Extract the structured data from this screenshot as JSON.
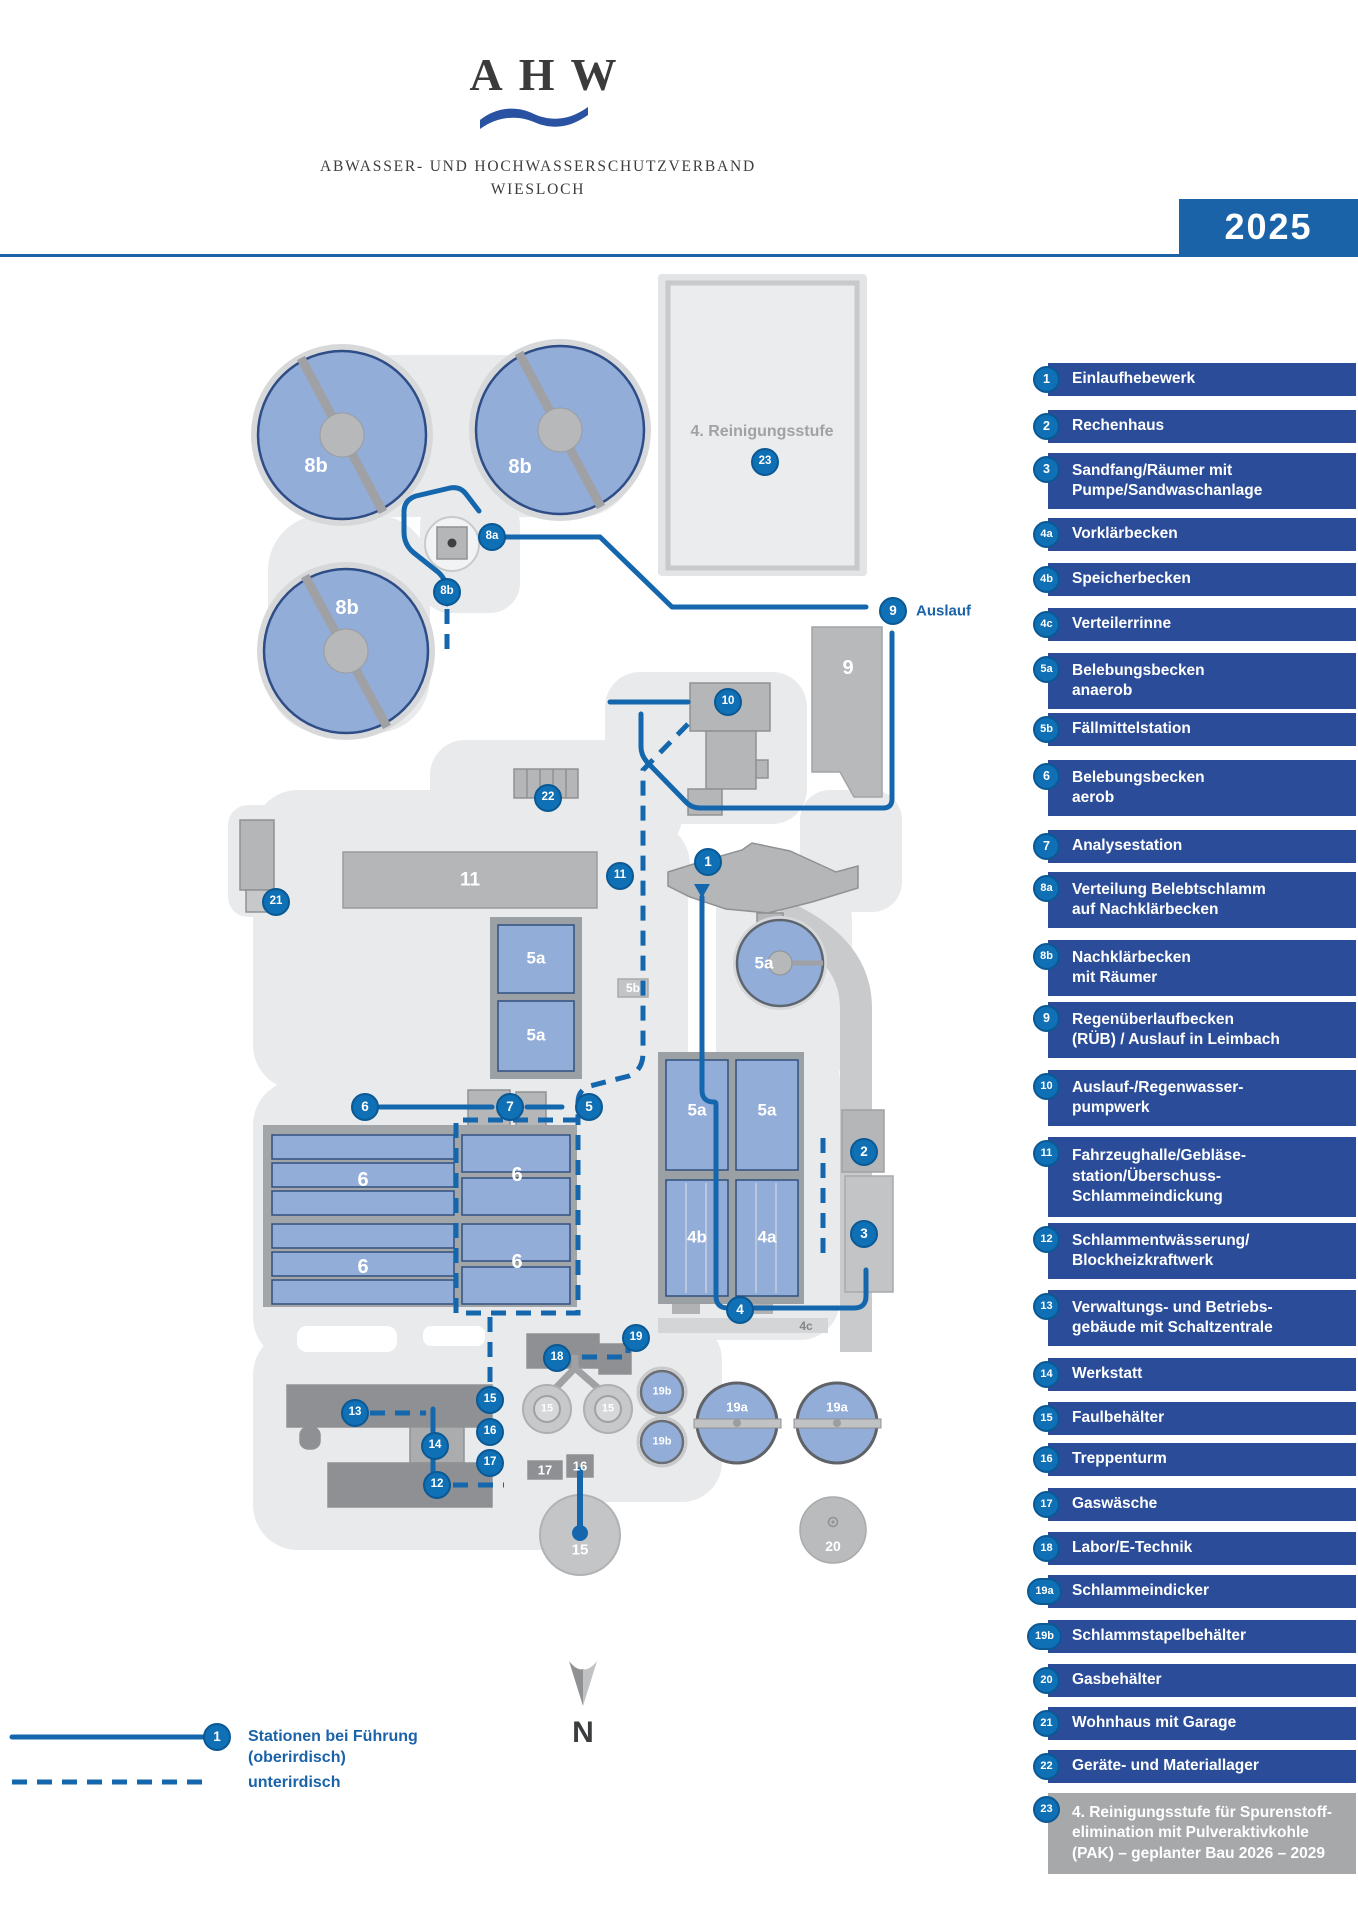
{
  "header": {
    "logo_acronym": "AHW",
    "org_line1": "ABWASSER- UND HOCHWASSERSCHUTZVERBAND",
    "org_line2": "WIESLOCH",
    "year": "2025"
  },
  "colors": {
    "accent_blue": "#1a63a9",
    "pipe_blue": "#1467ad",
    "legend_bar_blue": "#2b4d99",
    "marker_blue": "#0f70b5",
    "basin_blue": "#93add9",
    "ground_gray": "#e9eaeb",
    "building_gray": "#b4b6b8",
    "dark_building_gray": "#8e9093",
    "planned_gray": "#a6a8aa"
  },
  "legend": {
    "items": [
      {
        "num": "1",
        "label": "Einlaufhebewerk"
      },
      {
        "num": "2",
        "label": "Rechenhaus"
      },
      {
        "num": "3",
        "label": "Sandfang/Räumer mit\nPumpe/Sandwaschanlage"
      },
      {
        "num": "4a",
        "label": "Vorklärbecken"
      },
      {
        "num": "4b",
        "label": "Speicherbecken"
      },
      {
        "num": "4c",
        "label": "Verteilerrinne"
      },
      {
        "num": "5a",
        "label": "Belebungsbecken\nanaerob"
      },
      {
        "num": "5b",
        "label": "Fällmittelstation"
      },
      {
        "num": "6",
        "label": "Belebungsbecken\naerob"
      },
      {
        "num": "7",
        "label": "Analysestation"
      },
      {
        "num": "8a",
        "label": "Verteilung Belebtschlamm\nauf Nachklärbecken"
      },
      {
        "num": "8b",
        "label": "Nachklärbecken\nmit Räumer"
      },
      {
        "num": "9",
        "label": "Regenüberlaufbecken\n(RÜB) / Auslauf in Leimbach"
      },
      {
        "num": "10",
        "label": "Auslauf-/Regenwasser-\npumpwerk"
      },
      {
        "num": "11",
        "label": "Fahrzeughalle/Gebläse-\nstation/Überschuss-\nSchlammeindickung"
      },
      {
        "num": "12",
        "label": "Schlammentwässerung/\nBlockheizkraftwerk"
      },
      {
        "num": "13",
        "label": "Verwaltungs- und Betriebs-\ngebäude mit Schaltzentrale"
      },
      {
        "num": "14",
        "label": "Werkstatt"
      },
      {
        "num": "15",
        "label": "Faulbehälter"
      },
      {
        "num": "16",
        "label": "Treppenturm"
      },
      {
        "num": "17",
        "label": "Gaswäsche"
      },
      {
        "num": "18",
        "label": "Labor/E-Technik"
      },
      {
        "num": "19a",
        "label": "Schlammeindicker"
      },
      {
        "num": "19b",
        "label": "Schlammstapelbehälter"
      },
      {
        "num": "20",
        "label": "Gasbehälter"
      },
      {
        "num": "21",
        "label": "Wohnhaus mit Garage"
      },
      {
        "num": "22",
        "label": "Geräte- und Materiallager"
      },
      {
        "num": "23",
        "label": "4. Reinigungsstufe für Spurenstoff-\nelimination mit Pulveraktivkohle\n(PAK) – geplanter Bau 2026 – 2029"
      }
    ]
  },
  "map": {
    "markers": [
      {
        "n": "1"
      },
      {
        "n": "2"
      },
      {
        "n": "3"
      },
      {
        "n": "4"
      },
      {
        "n": "5"
      },
      {
        "n": "6"
      },
      {
        "n": "7"
      },
      {
        "n": "8a"
      },
      {
        "n": "8b"
      },
      {
        "n": "9"
      },
      {
        "n": "10"
      },
      {
        "n": "11"
      },
      {
        "n": "12"
      },
      {
        "n": "13"
      },
      {
        "n": "14"
      },
      {
        "n": "15"
      },
      {
        "n": "16"
      },
      {
        "n": "17"
      },
      {
        "n": "18"
      },
      {
        "n": "19"
      },
      {
        "n": "21"
      },
      {
        "n": "22"
      },
      {
        "n": "23"
      }
    ],
    "labels": [
      {
        "text": "8b"
      },
      {
        "text": "8b"
      },
      {
        "text": "8b"
      },
      {
        "text": "9"
      },
      {
        "text": "11"
      },
      {
        "text": "5a"
      },
      {
        "text": "5a"
      },
      {
        "text": "5a"
      },
      {
        "text": "5a"
      },
      {
        "text": "5a"
      },
      {
        "text": "4b"
      },
      {
        "text": "4a"
      },
      {
        "text": "6"
      },
      {
        "text": "6"
      },
      {
        "text": "6"
      },
      {
        "text": "6"
      },
      {
        "text": "15"
      },
      {
        "text": "15"
      },
      {
        "text": "15"
      },
      {
        "text": "19b"
      },
      {
        "text": "19b"
      },
      {
        "text": "19a"
      },
      {
        "text": "19a"
      },
      {
        "text": "20"
      },
      {
        "text": "5b"
      },
      {
        "text": "17"
      },
      {
        "text": "16"
      },
      {
        "text": "4c"
      },
      {
        "text": "4. Reinigungsstufe"
      },
      {
        "text": "Auslauf"
      },
      {
        "text": "N"
      }
    ],
    "flow_legend": {
      "marker": "1",
      "line1": "Stationen bei Führung",
      "line2": "(oberirdisch)",
      "line3": "unterirdisch"
    }
  }
}
